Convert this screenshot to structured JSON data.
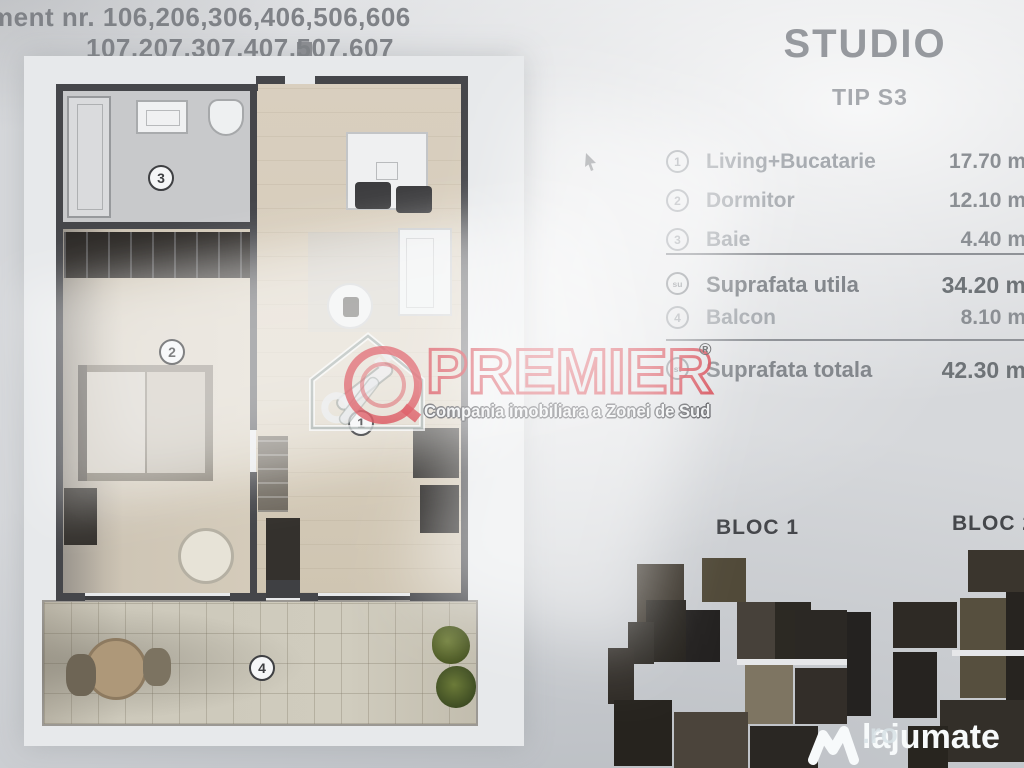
{
  "header": {
    "line1": "ment nr. 106,206,306,406,506,606",
    "line2": "107,207,307,407,507,607"
  },
  "panel": {
    "title": "STUDIO",
    "subtitle": "TIP S3",
    "rooms": [
      {
        "num": "1",
        "label": "Living+Bucatarie",
        "value": "17.70 m"
      },
      {
        "num": "2",
        "label": "Dormitor",
        "value": "12.10 m"
      },
      {
        "num": "3",
        "label": "Baie",
        "value": "4.40 m"
      }
    ],
    "totals": [
      {
        "icon": "su",
        "label": "Suprafata utila",
        "value": "34.20 m"
      },
      {
        "num": "4",
        "label": "Balcon",
        "value": "8.10 m"
      },
      {
        "icon": "st",
        "label": "Suprafata totala",
        "value": "42.30 m"
      }
    ],
    "bloc1": "BLOC 1",
    "bloc2": "BLOC 2"
  },
  "plan": {
    "room_labels": [
      "1",
      "2",
      "3",
      "4"
    ]
  },
  "watermarks": {
    "premier": {
      "name": "PREMIER",
      "reg": "®",
      "tagline": "Compania imobiliara a Zonei de Sud",
      "red": "#d2303c"
    },
    "lajumate": {
      "name": "lajumate",
      "tld": ".ro"
    }
  },
  "colors": {
    "wall": "#45464a",
    "paper": "#e7e9eb",
    "premier_red": "#d2303c"
  }
}
